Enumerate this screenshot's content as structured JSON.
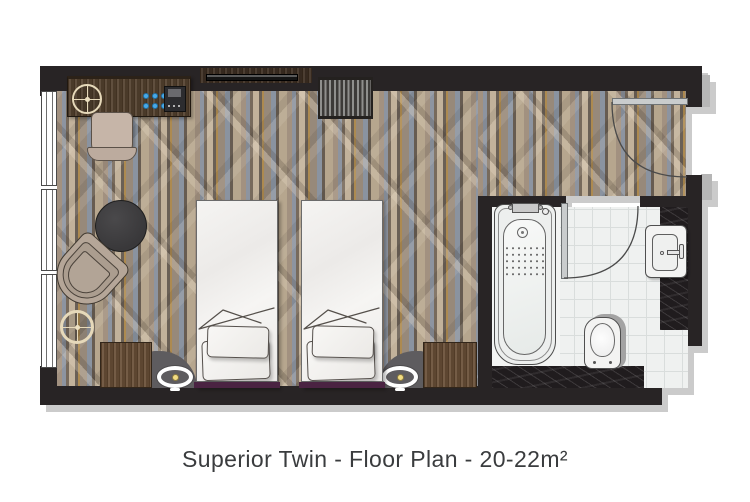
{
  "caption": {
    "text": "Superior Twin - Floor Plan - 20-22m²"
  },
  "room": {
    "type": "Superior Twin",
    "area": "20-22m²",
    "view": "top-down floor plan"
  },
  "palette": {
    "background": "#ffffff",
    "wall": "#282425",
    "plan_shadow": "#cbcbcb",
    "carpet_base": "#958a7c",
    "carpet_bluegray": "#8d94a0",
    "carpet_gold": "#ad8a50",
    "carpet_cream": "#c2b29b",
    "headboard_plum": "#4a2342",
    "bed_linen": "#f2f1ef",
    "tile": "#eff1f0",
    "tile_grout": "#d9dddc",
    "marble_dark": "#201c1e",
    "desk_wood": "#54422f",
    "table_wood": "#6a5038",
    "pouf_gray": "#5e5c5f",
    "chair_beige": "#c6b5a8",
    "lamp_glow": "#f2dc82",
    "glass_blue": "#49a8e6",
    "fixture_white": "#f3f3f2",
    "door_gray": "#c9cccd"
  },
  "fixtures": [
    {
      "name": "window"
    },
    {
      "name": "desk"
    },
    {
      "name": "desk-chair"
    },
    {
      "name": "welcome-tray"
    },
    {
      "name": "glass-tray"
    },
    {
      "name": "coffee-machine"
    },
    {
      "name": "wall-tv"
    },
    {
      "name": "luggage-rack"
    },
    {
      "name": "coffee-table"
    },
    {
      "name": "armchair"
    },
    {
      "name": "side-table"
    },
    {
      "name": "twin-bed-left"
    },
    {
      "name": "twin-bed-right"
    },
    {
      "name": "nightstand-left"
    },
    {
      "name": "nightstand-right"
    },
    {
      "name": "bedside-lamp-left"
    },
    {
      "name": "bedside-lamp-right"
    },
    {
      "name": "entry-door"
    },
    {
      "name": "bathroom-door"
    },
    {
      "name": "bathtub"
    },
    {
      "name": "toilet"
    },
    {
      "name": "washbasin"
    }
  ]
}
